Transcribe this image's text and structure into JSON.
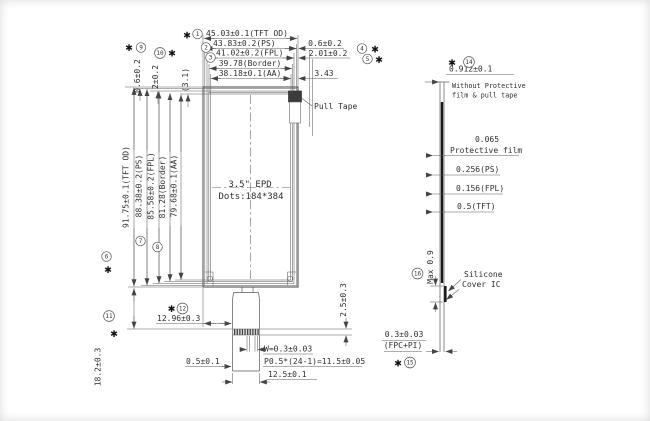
{
  "marker": "✱",
  "front": {
    "panel": {
      "size_label": "3.5\" EPD",
      "dots_label": "Dots:184*384",
      "pull_tape_label": "Pull Tape"
    },
    "top_dims": [
      {
        "num": "1",
        "text": "45.03±0.1(TFT OD)"
      },
      {
        "num": "2",
        "text": "43.83±0.2(PS)"
      },
      {
        "num": "3",
        "text": "41.02±0.2(FPL)"
      },
      {
        "num": "",
        "text": "39.78(Border)"
      },
      {
        "num": "",
        "text": "38.18±0.1(AA)"
      }
    ],
    "top_right_dims": [
      {
        "num": "4",
        "text": "0.6±0.2"
      },
      {
        "num": "5",
        "text": "2.01±0.2"
      },
      {
        "num": "",
        "text": "3.43"
      }
    ],
    "left_top_dims": [
      {
        "num": "9",
        "text": "0.6±0.2"
      },
      {
        "num": "10",
        "text": "2±0.2"
      },
      {
        "num": "",
        "text": "(3.1)"
      }
    ],
    "left_dims": [
      {
        "num": "6",
        "text": "91.75±0.1(TFT OD)"
      },
      {
        "num": "7",
        "text": "88.38±0.2(PS)"
      },
      {
        "num": "8",
        "text": "85.58±0.2(FPL)"
      },
      {
        "num": "",
        "text": "81.28(Border)"
      },
      {
        "num": "",
        "text": "79.68±0.1(AA)"
      }
    ],
    "bottom_dims": {
      "fpc_offset": {
        "num": "12",
        "text": "12.96±0.3"
      },
      "tail_len": {
        "num": "11",
        "text": "18.2±0.3"
      },
      "edge_gap": "0.5±0.1",
      "pin_width": "W=0.3±0.03",
      "pin_pitch": "P0.5*(24-1)=11.5±0.05",
      "fpc_width": "12.5±0.1",
      "contact_len": "2.5±0.3"
    }
  },
  "section": {
    "total_thickness": {
      "num": "14",
      "text": "0.912±0.1",
      "note_line1": "Without Protective",
      "note_line2": "film & pull tape"
    },
    "protective_film": {
      "value": "0.065",
      "label": "Protective film"
    },
    "ps": "0.256(PS)",
    "fpl": "0.156(FPL)",
    "tft": "0.5(TFT)",
    "cover_ic": {
      "num": "16",
      "max_height": "Max 0.9",
      "label_line1": "Silicone",
      "label_line2": "Cover IC"
    },
    "fpc": {
      "num": "15",
      "text": "0.3±0.03",
      "text2": "(FPC+PI)"
    }
  }
}
